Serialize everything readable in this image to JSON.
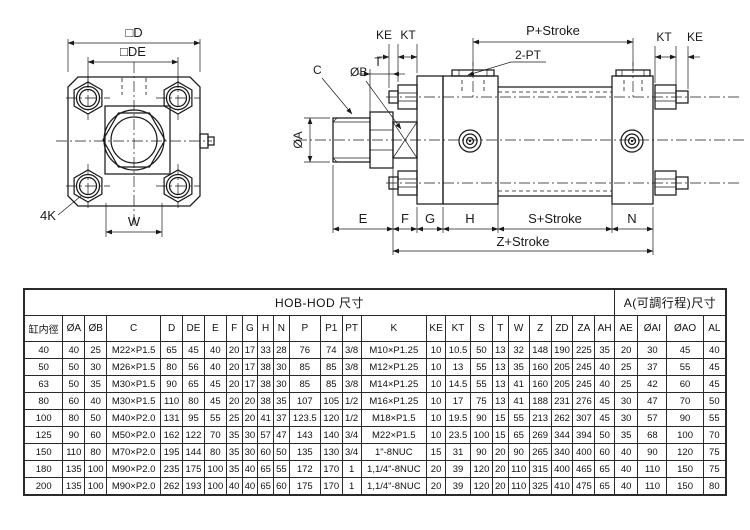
{
  "front_view": {
    "dim_d": "□D",
    "dim_de": "□DE",
    "dim_w": "W",
    "dim_4k": "4K"
  },
  "side_view": {
    "dim_ke_left": "KE",
    "dim_kt_left": "KT",
    "dim_t": "T",
    "dim_c": "C",
    "dim_ob": "ØB",
    "dim_oa": "ØA",
    "dim_p_stroke": "P+Stroke",
    "dim_2pt": "2-PT",
    "dim_kt_right": "KT",
    "dim_ke_right": "KE",
    "dim_e": "E",
    "dim_f": "F",
    "dim_g": "G",
    "dim_h": "H",
    "dim_s_stroke": "S+Stroke",
    "dim_n": "N",
    "dim_z_stroke": "Z+Stroke"
  },
  "table": {
    "title_main": "HOB-HOD 尺寸",
    "title_adjustable": "A(可調行程)尺寸",
    "main_span": 24,
    "adjustable_span": 4,
    "columns": [
      "缸内徑",
      "ØA",
      "ØB",
      "C",
      "D",
      "DE",
      "E",
      "F",
      "G",
      "H",
      "N",
      "P",
      "P1",
      "PT",
      "K",
      "KE",
      "KT",
      "S",
      "T",
      "W",
      "Z",
      "ZD",
      "ZA",
      "AH",
      "AE",
      "ØAI",
      "ØAO",
      "AL"
    ],
    "rows": [
      [
        "40",
        "40",
        "25",
        "M22×P1.5",
        "65",
        "45",
        "40",
        "20",
        "17",
        "33",
        "28",
        "76",
        "74",
        "3/8",
        "M10×P1.25",
        "10",
        "10.5",
        "50",
        "13",
        "32",
        "148",
        "190",
        "225",
        "35",
        "20",
        "30",
        "45",
        "40"
      ],
      [
        "50",
        "50",
        "30",
        "M26×P1.5",
        "80",
        "56",
        "40",
        "20",
        "17",
        "38",
        "30",
        "85",
        "85",
        "3/8",
        "M12×P1.25",
        "10",
        "13",
        "55",
        "13",
        "35",
        "160",
        "205",
        "245",
        "40",
        "25",
        "37",
        "55",
        "45"
      ],
      [
        "63",
        "50",
        "35",
        "M30×P1.5",
        "90",
        "65",
        "45",
        "20",
        "17",
        "38",
        "30",
        "85",
        "85",
        "3/8",
        "M14×P1.25",
        "10",
        "14.5",
        "55",
        "13",
        "41",
        "160",
        "205",
        "245",
        "40",
        "25",
        "42",
        "60",
        "45"
      ],
      [
        "80",
        "60",
        "40",
        "M30×P1.5",
        "110",
        "80",
        "45",
        "20",
        "20",
        "38",
        "35",
        "107",
        "105",
        "1/2",
        "M16×P1.25",
        "10",
        "17",
        "75",
        "13",
        "41",
        "188",
        "231",
        "276",
        "45",
        "30",
        "47",
        "70",
        "50"
      ],
      [
        "100",
        "80",
        "50",
        "M40×P2.0",
        "131",
        "95",
        "55",
        "25",
        "20",
        "41",
        "37",
        "123.5",
        "120",
        "1/2",
        "M18×P1.5",
        "10",
        "19.5",
        "90",
        "15",
        "55",
        "213",
        "262",
        "307",
        "45",
        "30",
        "57",
        "90",
        "55"
      ],
      [
        "125",
        "90",
        "60",
        "M50×P2.0",
        "162",
        "122",
        "70",
        "35",
        "30",
        "57",
        "47",
        "143",
        "140",
        "3/4",
        "M22×P1.5",
        "10",
        "23.5",
        "100",
        "15",
        "65",
        "269",
        "344",
        "394",
        "50",
        "35",
        "68",
        "100",
        "70"
      ],
      [
        "150",
        "110",
        "80",
        "M70×P2.0",
        "195",
        "144",
        "80",
        "35",
        "30",
        "60",
        "50",
        "135",
        "130",
        "3/4",
        "1\"-8NUC",
        "15",
        "31",
        "90",
        "20",
        "90",
        "265",
        "340",
        "400",
        "60",
        "40",
        "90",
        "120",
        "75"
      ],
      [
        "180",
        "135",
        "100",
        "M90×P2.0",
        "235",
        "175",
        "100",
        "35",
        "40",
        "65",
        "55",
        "172",
        "170",
        "1",
        "1,1/4\"-8NUC",
        "20",
        "39",
        "120",
        "20",
        "110",
        "315",
        "400",
        "465",
        "65",
        "40",
        "110",
        "150",
        "75"
      ],
      [
        "200",
        "135",
        "100",
        "M90×P2.0",
        "262",
        "193",
        "100",
        "40",
        "40",
        "65",
        "60",
        "175",
        "170",
        "1",
        "1,1/4\"-8NUC",
        "20",
        "39",
        "120",
        "20",
        "110",
        "325",
        "410",
        "475",
        "65",
        "40",
        "110",
        "150",
        "80"
      ]
    ]
  }
}
